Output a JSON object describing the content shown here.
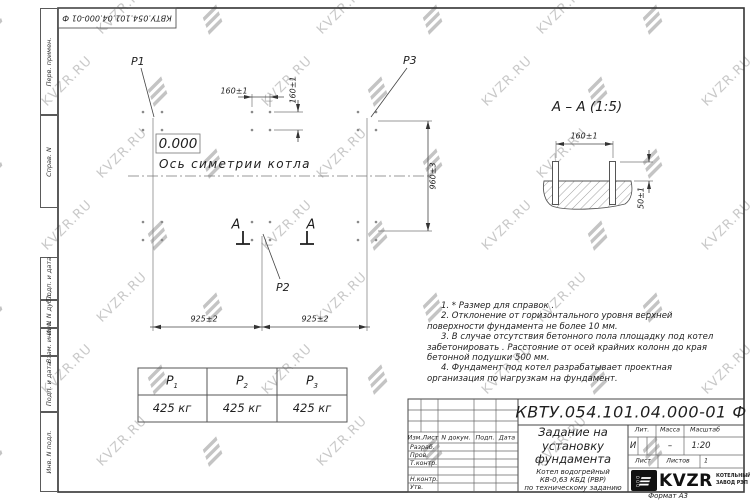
{
  "stamp_top": "КВТУ.054.101.04.000-01 Ф",
  "watermark": {
    "text": "KVZR.RU",
    "icon_name": "kvzr-bars-icon",
    "color": "#c9c9c9"
  },
  "colors": {
    "line": "#3d3d3d",
    "watermark": "#c9c9c9"
  },
  "margin_column": [
    {
      "label": "Перв. примен."
    },
    {
      "label": "Справ. N"
    },
    {
      "label": "Подп. и дата"
    },
    {
      "label": "Инв. N дубл."
    },
    {
      "label": "Взам. инв. N"
    },
    {
      "label": "Подп. и дата"
    },
    {
      "label": "Инв. N подл."
    }
  ],
  "plan": {
    "p1": "P1",
    "p2": "P2",
    "p3": "P3",
    "elevation": "0.000",
    "axis_label": "Ось симетрии котла",
    "dim_bolt_spacing_h": "160±1",
    "dim_bolt_spacing_v": "160±1",
    "dim_depth": "960±3",
    "dim_span_left": "925±2",
    "dim_span_right": "925±2",
    "section_mark": "A"
  },
  "section_view": {
    "title": "A – A (1:5)",
    "dim_bolt_spacing": "160±1",
    "dim_protrusion": "50±1"
  },
  "load_table": {
    "columns": [
      {
        "name": "P",
        "sub": "1",
        "value": "425 кг"
      },
      {
        "name": "P",
        "sub": "2",
        "value": "425 кг"
      },
      {
        "name": "P",
        "sub": "3",
        "value": "425 кг"
      }
    ]
  },
  "notes": [
    "1. * Размер для справок .",
    "2. Отклонение от горизонтального уровня верхней поверхности фундамента не более 10 мм.",
    "3. В случае отсутствия бетонного пола площадку под котел забетонировать . Расстояние от осей крайних колонн до края бетонной подушки 500 мм.",
    "4. Фундамент под котел разрабатывает проектная организация по нагрузкам на фундамент."
  ],
  "title_block": {
    "doc_number": "КВТУ.054.101.04.000-01 Ф",
    "title_lines": [
      "Задание на",
      "установку",
      "фундамента"
    ],
    "subtitle_lines": [
      "Котел водогрейный",
      "КВ-0,63 КБД (РВР)",
      "по техническому заданию"
    ],
    "change_header": [
      "Изм.Лист",
      "N докум.",
      "Подп.",
      "Дата"
    ],
    "signature_rows": [
      "Разраб.",
      "Пров.",
      "Т.контр.",
      "Н.контр.",
      "Утв."
    ],
    "lit_label": "Лит.",
    "lit_value": "И",
    "mass_label": "Масса",
    "mass_value": "–",
    "scale_label": "Масштаб",
    "scale_value": "1:20",
    "sheet_label": "Лист",
    "sheets_label": "Листов",
    "sheets_value": "1",
    "company": {
      "ooo": "ООО",
      "name": "KVZR",
      "line1": "КОТЕЛЬНЫЙ",
      "line2": "ЗАВОД РЭП"
    },
    "format_label": "Формат А3"
  }
}
